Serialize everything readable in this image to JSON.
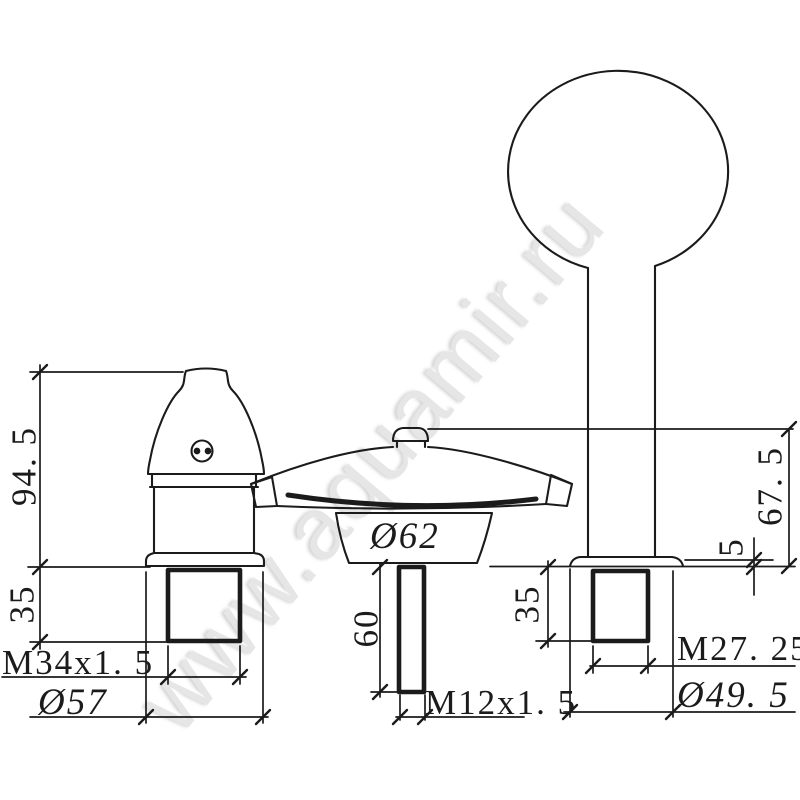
{
  "watermark": {
    "text": "www.aquamir.ru"
  },
  "colors": {
    "line": "#1b1b1b",
    "background": "#ffffff",
    "watermark": "#e6e6e6"
  },
  "drawing_type": "technical dimension drawing, 3-hole bath mixer (two handles and waterfall spout)",
  "dimensions": {
    "left_handle": {
      "height": "94. 5",
      "thread_length": "35",
      "thread_spec": "M34x1. 5",
      "base_diameter": "Ø57"
    },
    "spout": {
      "body_diameter": "Ø62",
      "shank_length": "60",
      "shank_thread": "M12x1. 5"
    },
    "right_handle": {
      "height": "67. 5",
      "flange_thickness": "5",
      "thread_length": "35",
      "thread_spec": "M27. 25",
      "base_diameter": "Ø49. 5"
    }
  }
}
